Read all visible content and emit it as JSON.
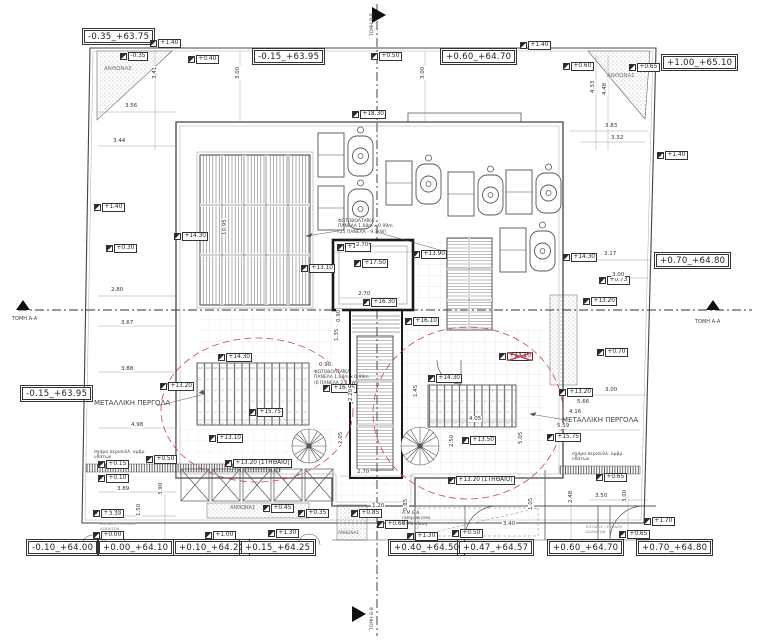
{
  "drawing": {
    "section_label_aa": "ΤΟΜΗ Α-Α",
    "section_label_bb": "ΤΟΜΗ Β-Β",
    "accent_red": "#cc4455",
    "line_color": "#4d4d4d"
  },
  "level_boxes": [
    {
      "t": "-0.35_+63.75",
      "x": 84,
      "y": 30
    },
    {
      "t": "-0.15_+63.95",
      "x": 254,
      "y": 50
    },
    {
      "t": "+0.60_+64.70",
      "x": 442,
      "y": 50
    },
    {
      "t": "+1.00_+65.10",
      "x": 663,
      "y": 56
    },
    {
      "t": "-0.15_+63.95",
      "x": 22,
      "y": 387
    },
    {
      "t": "+0.70_+64.80",
      "x": 656,
      "y": 254
    },
    {
      "t": "-0.10_+64.00",
      "x": 28,
      "y": 541
    },
    {
      "t": "+0.00_+64.10",
      "x": 99,
      "y": 541
    },
    {
      "t": "+0.10_+64.20",
      "x": 175,
      "y": 541
    },
    {
      "t": "+0.15_+64.25",
      "x": 241,
      "y": 541
    },
    {
      "t": "+0.40_+64.50",
      "x": 390,
      "y": 541
    },
    {
      "t": "+0.47_+64.57",
      "x": 459,
      "y": 541
    },
    {
      "t": "+0.60_+64.70",
      "x": 549,
      "y": 541
    },
    {
      "t": "+0.70_+64.80",
      "x": 638,
      "y": 541
    }
  ],
  "spot_levels": [
    {
      "t": "+1.40",
      "x": 150,
      "y": 39
    },
    {
      "t": "-0.35",
      "x": 120,
      "y": 52
    },
    {
      "t": "+0.40",
      "x": 188,
      "y": 55
    },
    {
      "t": "+0.50",
      "x": 371,
      "y": 52
    },
    {
      "t": "+1.40",
      "x": 520,
      "y": 41
    },
    {
      "t": "+0.60",
      "x": 563,
      "y": 62
    },
    {
      "t": "+0.65",
      "x": 629,
      "y": 63
    },
    {
      "t": "+1.40",
      "x": 657,
      "y": 151
    },
    {
      "t": "+18.30",
      "x": 352,
      "y": 110
    },
    {
      "t": "+1.40",
      "x": 94,
      "y": 203
    },
    {
      "t": "+0.30",
      "x": 106,
      "y": 244
    },
    {
      "t": "+14.30",
      "x": 174,
      "y": 232
    },
    {
      "t": "+17.85",
      "x": 337,
      "y": 243
    },
    {
      "t": "+17.50",
      "x": 354,
      "y": 259
    },
    {
      "t": "+13.90",
      "x": 413,
      "y": 250
    },
    {
      "t": "+14.30",
      "x": 563,
      "y": 253
    },
    {
      "t": "+13.10",
      "x": 301,
      "y": 264
    },
    {
      "t": "+0.73",
      "x": 599,
      "y": 276
    },
    {
      "t": "+13.20",
      "x": 583,
      "y": 297
    },
    {
      "t": "+16.30",
      "x": 363,
      "y": 298
    },
    {
      "t": "+16.10",
      "x": 405,
      "y": 317
    },
    {
      "t": "+0.70",
      "x": 597,
      "y": 348
    },
    {
      "t": "+14.10",
      "x": 499,
      "y": 352,
      "red": true
    },
    {
      "t": "+14.30",
      "x": 218,
      "y": 353
    },
    {
      "t": "+13.20",
      "x": 160,
      "y": 382
    },
    {
      "t": "+16.95",
      "x": 323,
      "y": 384
    },
    {
      "t": "+14.30",
      "x": 428,
      "y": 374
    },
    {
      "t": "+13.20",
      "x": 559,
      "y": 388
    },
    {
      "t": "+15.75",
      "x": 249,
      "y": 408
    },
    {
      "t": "+13.10",
      "x": 209,
      "y": 434
    },
    {
      "t": "+13.50",
      "x": 462,
      "y": 436
    },
    {
      "t": "+15.75",
      "x": 547,
      "y": 433
    },
    {
      "t": "+13.20 (ΣΤΗΘΑΙΟ)",
      "x": 225,
      "y": 459
    },
    {
      "t": "+13.20 (ΣΤΗΘΑΙΟ)",
      "x": 448,
      "y": 476
    },
    {
      "t": "+0.15",
      "x": 98,
      "y": 460
    },
    {
      "t": "+0.10",
      "x": 98,
      "y": 474
    },
    {
      "t": "+0.50",
      "x": 146,
      "y": 455
    },
    {
      "t": "+0.65",
      "x": 596,
      "y": 473
    },
    {
      "t": "+1.00",
      "x": 93,
      "y": 509
    },
    {
      "t": "+0.00",
      "x": 93,
      "y": 531
    },
    {
      "t": "+0.45",
      "x": 263,
      "y": 504
    },
    {
      "t": "+0.35",
      "x": 298,
      "y": 509
    },
    {
      "t": "+0.85",
      "x": 351,
      "y": 509
    },
    {
      "t": "+0.60",
      "x": 377,
      "y": 520
    },
    {
      "t": "+1.00",
      "x": 205,
      "y": 531
    },
    {
      "t": "+1.30",
      "x": 268,
      "y": 529
    },
    {
      "t": "+1.30",
      "x": 407,
      "y": 532
    },
    {
      "t": "+0.50",
      "x": 452,
      "y": 529
    },
    {
      "t": "+1.70",
      "x": 644,
      "y": 517
    },
    {
      "t": "+0.65",
      "x": 619,
      "y": 530
    }
  ],
  "dimensions": [
    {
      "t": "3.56",
      "x": 124,
      "y": 103
    },
    {
      "t": "3.44",
      "x": 112,
      "y": 138
    },
    {
      "t": "3.41",
      "x": 152,
      "y": 80,
      "r": 1
    },
    {
      "t": "3.00",
      "x": 235,
      "y": 80,
      "r": 1
    },
    {
      "t": "3.00",
      "x": 420,
      "y": 80,
      "r": 1
    },
    {
      "t": "4.33",
      "x": 590,
      "y": 94,
      "r": 1
    },
    {
      "t": "4.48",
      "x": 602,
      "y": 96,
      "r": 1
    },
    {
      "t": "3.83",
      "x": 604,
      "y": 123
    },
    {
      "t": "3.32",
      "x": 610,
      "y": 135
    },
    {
      "t": "2.80",
      "x": 110,
      "y": 287
    },
    {
      "t": "3.67",
      "x": 120,
      "y": 320
    },
    {
      "t": "3.88",
      "x": 120,
      "y": 366
    },
    {
      "t": "4.98",
      "x": 130,
      "y": 422
    },
    {
      "t": "3.17",
      "x": 603,
      "y": 251
    },
    {
      "t": "3.00",
      "x": 611,
      "y": 272
    },
    {
      "t": "3.00",
      "x": 604,
      "y": 387
    },
    {
      "t": "5.66",
      "x": 576,
      "y": 399
    },
    {
      "t": "4.16",
      "x": 568,
      "y": 409
    },
    {
      "t": "5.59",
      "x": 556,
      "y": 423
    },
    {
      "t": "2.70",
      "x": 355,
      "y": 242
    },
    {
      "t": "2.70",
      "x": 357,
      "y": 291
    },
    {
      "t": "2.70",
      "x": 356,
      "y": 469
    },
    {
      "t": "0.90",
      "x": 336,
      "y": 323,
      "r": 1
    },
    {
      "t": "1.35",
      "x": 334,
      "y": 342,
      "r": 1
    },
    {
      "t": "2.20",
      "x": 348,
      "y": 402,
      "r": 1
    },
    {
      "t": "0.90",
      "x": 318,
      "y": 362
    },
    {
      "t": "1.45",
      "x": 413,
      "y": 398,
      "r": 1
    },
    {
      "t": "4.05",
      "x": 468,
      "y": 416
    },
    {
      "t": "2.50",
      "x": 449,
      "y": 448,
      "r": 1
    },
    {
      "t": "5.05",
      "x": 518,
      "y": 445,
      "r": 1
    },
    {
      "t": "3.89",
      "x": 116,
      "y": 486
    },
    {
      "t": "3.39",
      "x": 108,
      "y": 511
    },
    {
      "t": "3.90",
      "x": 158,
      "y": 496,
      "r": 1
    },
    {
      "t": "1.50",
      "x": 136,
      "y": 517,
      "r": 1
    },
    {
      "t": "0.85",
      "x": 403,
      "y": 512,
      "r": 1
    },
    {
      "t": "1.20",
      "x": 371,
      "y": 503
    },
    {
      "t": "2.05",
      "x": 338,
      "y": 445,
      "r": 1
    },
    {
      "t": "3.40",
      "x": 502,
      "y": 521
    },
    {
      "t": "1.05",
      "x": 528,
      "y": 511,
      "r": 1
    },
    {
      "t": "3.50",
      "x": 594,
      "y": 493
    },
    {
      "t": "2.48",
      "x": 568,
      "y": 504,
      "r": 1
    },
    {
      "t": "3.00",
      "x": 622,
      "y": 503,
      "r": 1
    },
    {
      "t": "10.95",
      "x": 222,
      "y": 236,
      "r": 1
    }
  ],
  "annotations": [
    {
      "t": "ΑΝΘΩΝΑΣ",
      "x": 104,
      "y": 66,
      "s": 5.5,
      "c": "#777"
    },
    {
      "t": "ΑΝΘΩΝΑΣ",
      "x": 607,
      "y": 73,
      "s": 5.5,
      "c": "#777"
    },
    {
      "t": "ΑΝΘΩΝΑΣ",
      "x": 230,
      "y": 505,
      "s": 5,
      "c": "#666"
    },
    {
      "t": "ΑΝΘΩΝΑΣ",
      "x": 338,
      "y": 530,
      "s": 4.2,
      "c": "#666"
    },
    {
      "t": "ΜΕΤΑΛΛΙΚΗ ΠΕΡΓΟΛΑ",
      "x": 94,
      "y": 399,
      "s": 7
    },
    {
      "t": "ΜΕΤΑΛΛΙΚΗ ΠΕΡΓΟΛΑ",
      "x": 562,
      "y": 416,
      "s": 7
    },
    {
      "t": "ΦΩΤΟΒΟΛΤΑΪΚΑ\nΠΑΝΕΛΑ 1.68m x 0.99m\n(25 ΠΑΝΕΛΑ - 9.3kW)",
      "x": 338,
      "y": 219,
      "s": 4.5
    },
    {
      "t": "ΦΩΤΟΒΟΛΤΑΪΚΑ\nΠΑΝΕΛΑ 1.68m x 0.99m\n(6 ΠΑΝΕΛΑ 2.2 kW)",
      "x": 314,
      "y": 370,
      "s": 4.5
    },
    {
      "t": "σχάρα περισυλλ. ομβρ.\nυδάτων",
      "x": 94,
      "y": 450,
      "s": 4.5
    },
    {
      "t": "σχάρα περισυλλ. ομβρ.\nυδάτων",
      "x": 572,
      "y": 452,
      "s": 4.5
    },
    {
      "t": "Α.Μ.Ε.Α.\nramp access\n4.0% κλίση",
      "x": 402,
      "y": 511,
      "s": 4.5
    },
    {
      "t": "ΕΙΣΟΔΟΣ / ΕΞΟΔΟΣ\nΔΩΜΑΤΩΝ",
      "x": 100,
      "y": 522,
      "s": 3.8,
      "c": "#888"
    },
    {
      "t": "ΕΙΣΟΔΟΣ / ΕΞΟΔΟΣ\nΔΩΜΑΤΩΝ",
      "x": 586,
      "y": 525,
      "s": 3.8,
      "c": "#888"
    },
    {
      "t": "ΤΟΜΗ Α-Α",
      "x": 12,
      "y": 316,
      "s": 5
    },
    {
      "t": "ΤΟΜΗ Α-Α",
      "x": 695,
      "y": 319,
      "s": 5
    },
    {
      "t": "ΤΟΜΗ Β-Β",
      "x": 370,
      "y": 36,
      "s": 4.5,
      "r": -90
    },
    {
      "t": "ΤΟΜΗ Β-Β",
      "x": 370,
      "y": 630,
      "s": 4.5,
      "r": -90
    }
  ]
}
